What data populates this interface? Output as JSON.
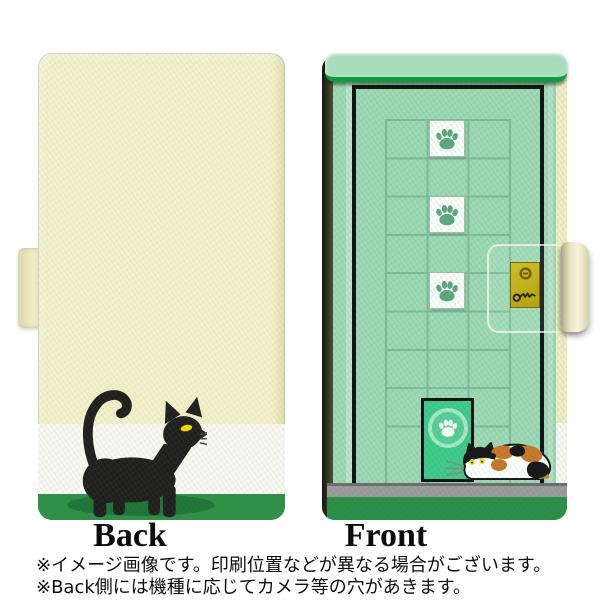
{
  "labels": {
    "back": "Back",
    "front": "Front"
  },
  "footnotes": {
    "line1": "※イメージ画像です。印刷位置などが異なる場合がございます。",
    "line2": "※Back側には機種に応じてカメラ等の穴があきます。"
  },
  "product": {
    "type": "flip phone case design preview",
    "back_design": "black cat walking on cream background with white and green stripes",
    "front_design": "green door with tiled window grid, paw print tiles, cat flap and calico cat",
    "paw_tiles_count": 3,
    "icons": [
      "paw-icon",
      "keyhole-icon",
      "key-icon"
    ]
  },
  "colors": {
    "cream": "#f2f0ca",
    "stripe_white": "#f8f8f4",
    "stripe_green": "#2e8f49",
    "shadow_green": "#1d7539",
    "cat_black": "#1f1f1f",
    "cat_eye": "#f2d703",
    "calico_orange": "#c9792b",
    "door_green": "#9ed9b5",
    "awning": "#a8ddbb",
    "awning_edge": "#13993f",
    "grid_line": "#7ebc9a",
    "flap_green": "#3ecb8c",
    "paw_green": "#5ea97f",
    "floor_gray": "#9c9c9c",
    "floor_edge": "#6e6e6e",
    "base_green": "#2e8f49",
    "spine_cream": "#f0edc4",
    "frame_black": "#141414"
  }
}
